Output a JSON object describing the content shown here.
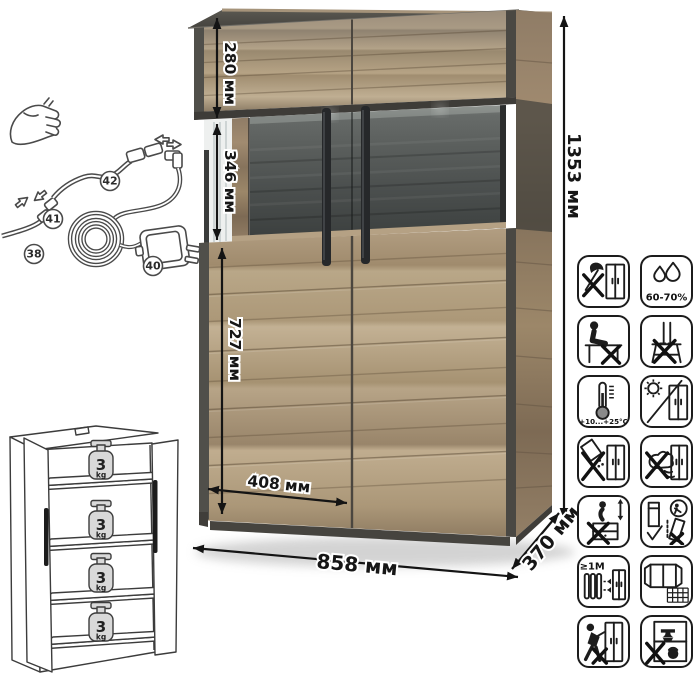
{
  "dimensions": {
    "total_height": "1353 мм",
    "total_width": "858 мм",
    "depth": "370 мм",
    "top_section_height": "280 мм",
    "glass_section_height": "346 мм",
    "lower_section_height": "727 мм",
    "door_width": "408 мм"
  },
  "cable_diagram": {
    "callouts": {
      "c38": "38",
      "c40": "40",
      "c41": "41",
      "c42": "42"
    }
  },
  "shelf_diagram": {
    "weights": [
      {
        "value": "3",
        "unit": "kg"
      },
      {
        "value": "3",
        "unit": "kg"
      },
      {
        "value": "3",
        "unit": "kg"
      },
      {
        "value": "3",
        "unit": "kg"
      }
    ]
  },
  "care_icons": {
    "items": [
      {
        "name": "no-sharp-tools",
        "label": ""
      },
      {
        "name": "humidity-range",
        "label": "60-70%"
      },
      {
        "name": "no-sitting",
        "label": ""
      },
      {
        "name": "no-standing",
        "label": ""
      },
      {
        "name": "temperature-range",
        "label": "+10...+25°C"
      },
      {
        "name": "avoid-direct-sunlight",
        "label": ""
      },
      {
        "name": "no-spilling-liquids",
        "label": ""
      },
      {
        "name": "no-wet-cleaning",
        "label": ""
      },
      {
        "name": "no-jumping-on-furniture",
        "label": ""
      },
      {
        "name": "transport-upright",
        "label": ""
      },
      {
        "name": "keep-1m-from-heat",
        "label": "≥1M"
      },
      {
        "name": "ventilate-room",
        "label": ""
      },
      {
        "name": "no-pushing",
        "label": ""
      },
      {
        "name": "no-overloading",
        "label": ""
      }
    ]
  },
  "colors": {
    "wood": "#ab9678",
    "wood_dark": "#8a7661",
    "trim": "#4c4a45",
    "glass": "#4b4f4e",
    "arrow": "#141414",
    "icon_border": "#1c1c1c"
  }
}
